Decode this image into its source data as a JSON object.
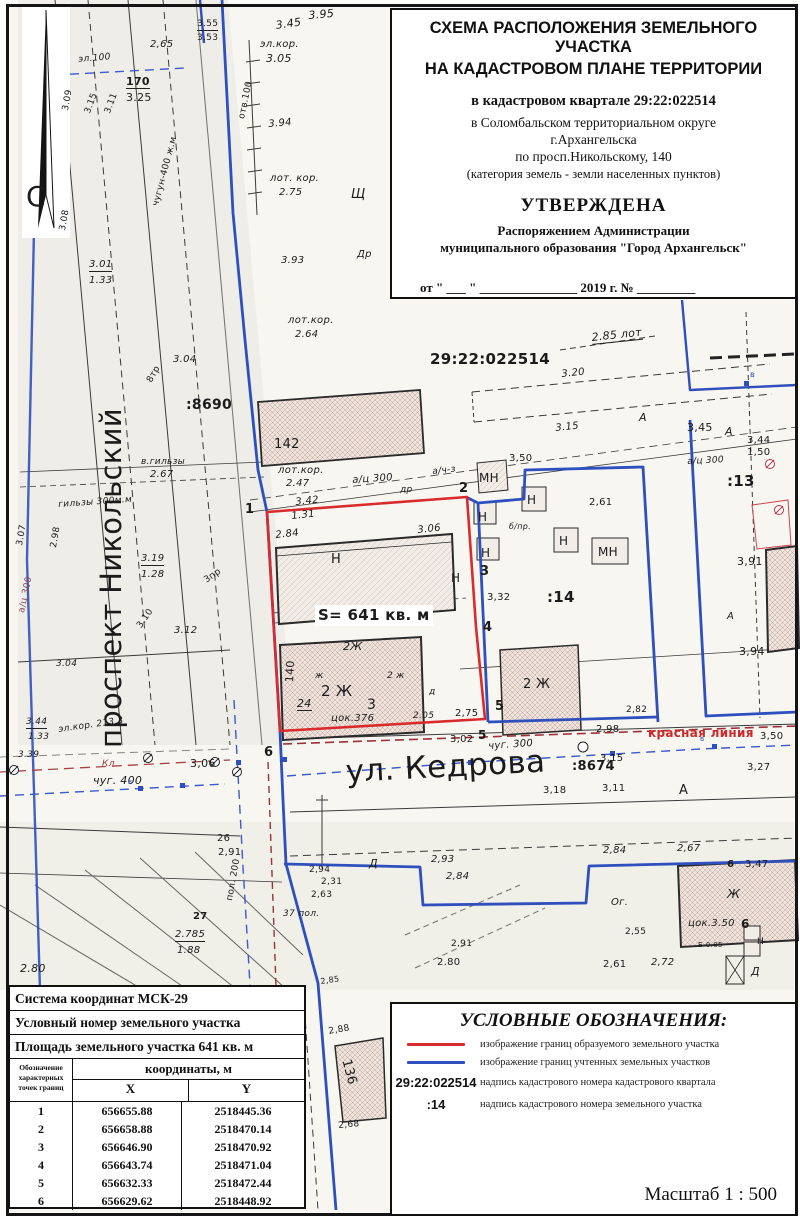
{
  "title_block": {
    "heading1": "СХЕМА РАСПОЛОЖЕНИЯ ЗЕМЕЛЬНОГО УЧАСТКА",
    "heading2": "НА КАДАСТРОВОМ ПЛАНЕ ТЕРРИТОРИИ",
    "quarter_line": "в кадастровом квартале 29:22:022514",
    "district_line1": "в Соломбальском территориальном округе",
    "district_line2": "г.Архангельска",
    "address_line": "по просп.Никольскому, 140",
    "category_line": "(категория земель - земли населенных пунктов)",
    "approved": "УТВЕРЖДЕНА",
    "approved_by1": "Распоряжением Администрации",
    "approved_by2": "муниципального образования \"Город Архангельск\"",
    "date_line": "от \" ___ \" _______________ 2019 г.  №  _________"
  },
  "legend": {
    "title": "УСЛОВНЫЕ ОБОЗНАЧЕНИЯ:",
    "items": [
      {
        "sample": "red",
        "symbol": "",
        "text": "изображение границ образуемого земельного участка"
      },
      {
        "sample": "blue",
        "symbol": "",
        "text": "изображение границ учтенных земельных участков"
      },
      {
        "sample": "label",
        "symbol": "29:22:022514",
        "text": "надпись кадастрового номера кадастрового квартала"
      },
      {
        "sample": "label",
        "symbol": ":14",
        "text": "надпись кадастрового номера земельного участка"
      }
    ],
    "scale": "Масштаб  1 : 500"
  },
  "table": {
    "row1": "Система координат МСК-29",
    "row2": "Условный номер земельного участка",
    "row3": "Площадь земельного участка 641 кв. м",
    "col_header_lines": [
      "Обозначение",
      "характерных",
      "точек границ"
    ],
    "coord_header": "координаты, м",
    "x_header": "X",
    "y_header": "Y",
    "rows": [
      [
        "1",
        "656655.88",
        "2518445.36"
      ],
      [
        "2",
        "656658.88",
        "2518470.14"
      ],
      [
        "3",
        "656646.90",
        "2518470.92"
      ],
      [
        "4",
        "656643.74",
        "2518471.04"
      ],
      [
        "5",
        "656632.33",
        "2518472.44"
      ],
      [
        "6",
        "656629.62",
        "2518448.92"
      ]
    ]
  },
  "colors": {
    "plot_boundary": "#d92b2b",
    "cadastral_boundary": "#2f4fbe",
    "red_line_text": "#cc2a2a"
  },
  "map": {
    "labels": [
      {
        "t": "С",
        "x": 26,
        "y": 183,
        "fs": 28
      },
      {
        "t": "проспект Никольский",
        "x": 97,
        "y": 748,
        "fs": 29,
        "rot": -90
      },
      {
        "t": "ул. Кедрова",
        "x": 345,
        "y": 757,
        "fs": 31,
        "rot": -3
      },
      {
        "t": "3.95",
        "x": 308,
        "y": 10,
        "fs": 11,
        "i": 1,
        "rot": -5
      },
      {
        "t": "3.45",
        "x": 275,
        "y": 20,
        "fs": 11,
        "i": 1,
        "rot": -8
      },
      {
        "t": "эл.кор.",
        "x": 260,
        "y": 40,
        "fs": 10,
        "i": 1
      },
      {
        "t": "3.05",
        "x": 266,
        "y": 53,
        "fs": 11,
        "i": 1
      },
      {
        "t": "2,65",
        "x": 150,
        "y": 40,
        "fs": 10,
        "i": 1
      },
      {
        "t": "170",
        "x": 126,
        "y": 76,
        "fs": 11,
        "b": 1,
        "u": 1
      },
      {
        "t": "3.25",
        "x": 126,
        "y": 92,
        "fs": 11
      },
      {
        "t": "3.55",
        "x": 197,
        "y": 20,
        "fs": 9,
        "u": 1
      },
      {
        "t": "3.53",
        "x": 197,
        "y": 34,
        "fs": 9
      },
      {
        "t": "эл.100",
        "x": 78,
        "y": 56,
        "fs": 9,
        "i": 1,
        "rot": -5
      },
      {
        "t": "отв.100",
        "x": 238,
        "y": 118,
        "fs": 9,
        "rot": -78
      },
      {
        "t": "3.94",
        "x": 268,
        "y": 120,
        "fs": 10,
        "i": 1,
        "rot": -5
      },
      {
        "t": "лот. кор.",
        "x": 270,
        "y": 174,
        "fs": 10,
        "i": 1
      },
      {
        "t": "2.75",
        "x": 279,
        "y": 188,
        "fs": 10,
        "i": 1
      },
      {
        "t": "Щ",
        "x": 351,
        "y": 188,
        "fs": 13,
        "i": 1
      },
      {
        "t": "3.93",
        "x": 281,
        "y": 256,
        "fs": 10,
        "i": 1
      },
      {
        "t": "Др",
        "x": 357,
        "y": 250,
        "fs": 10,
        "i": 1
      },
      {
        "t": "3.01",
        "x": 89,
        "y": 260,
        "fs": 10,
        "i": 1,
        "u": 1
      },
      {
        "t": "1.33",
        "x": 89,
        "y": 276,
        "fs": 10,
        "i": 1
      },
      {
        "t": "чугун-400 ж.м",
        "x": 152,
        "y": 205,
        "fs": 9,
        "rot": -75
      },
      {
        "t": "3.09",
        "x": 62,
        "y": 110,
        "fs": 9,
        "rot": -80
      },
      {
        "t": "3.15",
        "x": 84,
        "y": 112,
        "fs": 9,
        "rot": -70
      },
      {
        "t": "3.11",
        "x": 104,
        "y": 112,
        "fs": 9,
        "rot": -70
      },
      {
        "t": "3.08",
        "x": 59,
        "y": 230,
        "fs": 9,
        "rot": -80
      },
      {
        "t": "лот.кор.",
        "x": 288,
        "y": 316,
        "fs": 10,
        "i": 1
      },
      {
        "t": "2.64",
        "x": 295,
        "y": 330,
        "fs": 10,
        "i": 1
      },
      {
        "t": ":8690",
        "x": 186,
        "y": 398,
        "fs": 14,
        "b": 1
      },
      {
        "t": "142",
        "x": 274,
        "y": 438,
        "fs": 13
      },
      {
        "t": "в.гильзы",
        "x": 141,
        "y": 458,
        "fs": 9,
        "i": 1
      },
      {
        "t": "2.67",
        "x": 150,
        "y": 470,
        "fs": 10,
        "i": 1
      },
      {
        "t": "гильзы 300м.м",
        "x": 58,
        "y": 501,
        "fs": 9,
        "i": 1,
        "rot": -4
      },
      {
        "t": "3.04",
        "x": 173,
        "y": 355,
        "fs": 10,
        "i": 1
      },
      {
        "t": "8тр",
        "x": 146,
        "y": 380,
        "fs": 9,
        "rot": -60
      },
      {
        "t": "лот.кор.",
        "x": 278,
        "y": 466,
        "fs": 10,
        "i": 1
      },
      {
        "t": "2.47",
        "x": 286,
        "y": 479,
        "fs": 10,
        "i": 1
      },
      {
        "t": "3.19",
        "x": 141,
        "y": 554,
        "fs": 10,
        "i": 1,
        "u": 1
      },
      {
        "t": "1.28",
        "x": 141,
        "y": 570,
        "fs": 10,
        "i": 1
      },
      {
        "t": "3пр",
        "x": 203,
        "y": 578,
        "fs": 9,
        "rot": -35
      },
      {
        "t": "3.12",
        "x": 174,
        "y": 626,
        "fs": 10,
        "i": 1
      },
      {
        "t": "3.10",
        "x": 136,
        "y": 625,
        "fs": 9,
        "rot": -55
      },
      {
        "t": "3.04",
        "x": 56,
        "y": 660,
        "fs": 9,
        "i": 1
      },
      {
        "t": "3.44",
        "x": 26,
        "y": 718,
        "fs": 9,
        "i": 1,
        "u": 1
      },
      {
        "t": "1.33",
        "x": 28,
        "y": 733,
        "fs": 9,
        "i": 1
      },
      {
        "t": "эл.кор. 213.3",
        "x": 58,
        "y": 726,
        "fs": 9,
        "i": 1,
        "rot": -8
      },
      {
        "t": "3.39",
        "x": 18,
        "y": 751,
        "fs": 9,
        "i": 1
      },
      {
        "t": "а/ц 300",
        "x": 18,
        "y": 612,
        "fs": 9,
        "rot": -78,
        "c": "#8a4a52"
      },
      {
        "t": "3.07",
        "x": 16,
        "y": 545,
        "fs": 9,
        "rot": -80
      },
      {
        "t": "2.98",
        "x": 50,
        "y": 547,
        "fs": 9,
        "rot": -80
      },
      {
        "t": "Кл",
        "x": 102,
        "y": 760,
        "fs": 9,
        "c": "#a03c3c",
        "i": 1
      },
      {
        "t": "чуг. 400",
        "x": 93,
        "y": 775,
        "fs": 11,
        "i": 1
      },
      {
        "t": "3,06",
        "x": 190,
        "y": 758,
        "fs": 11
      },
      {
        "t": "6",
        "x": 264,
        "y": 746,
        "fs": 13,
        "b": 1
      },
      {
        "t": "в",
        "x": 128,
        "y": 779,
        "fs": 7,
        "c": "#2f4fbe"
      },
      {
        "t": "в",
        "x": 700,
        "y": 736,
        "fs": 7,
        "c": "#2f4fbe"
      },
      {
        "t": "в",
        "x": 750,
        "y": 371,
        "fs": 8,
        "c": "#2f4fbe"
      },
      {
        "t": "чуг. 300",
        "x": 488,
        "y": 742,
        "fs": 10,
        "i": 1,
        "rot": -4
      },
      {
        "t": ":8674",
        "x": 572,
        "y": 760,
        "fs": 13,
        "b": 1
      },
      {
        "t": "3,15",
        "x": 600,
        "y": 754,
        "fs": 10
      },
      {
        "t": "2,98",
        "x": 596,
        "y": 725,
        "fs": 10
      },
      {
        "t": "красная линия",
        "x": 648,
        "y": 727,
        "fs": 12,
        "b": 1,
        "c": "#cc2a2a"
      },
      {
        "t": "3,50",
        "x": 760,
        "y": 732,
        "fs": 10
      },
      {
        "t": "3,02",
        "x": 450,
        "y": 735,
        "fs": 10
      },
      {
        "t": "5",
        "x": 478,
        "y": 729,
        "fs": 12,
        "b": 1
      },
      {
        "t": "3,18",
        "x": 543,
        "y": 786,
        "fs": 10
      },
      {
        "t": "3,11",
        "x": 602,
        "y": 784,
        "fs": 10
      },
      {
        "t": "А",
        "x": 679,
        "y": 784,
        "fs": 13
      },
      {
        "t": "3,27",
        "x": 747,
        "y": 763,
        "fs": 10
      },
      {
        "t": "26",
        "x": 217,
        "y": 834,
        "fs": 10
      },
      {
        "t": "2,91",
        "x": 218,
        "y": 848,
        "fs": 10
      },
      {
        "t": "пол. 200",
        "x": 226,
        "y": 900,
        "fs": 9,
        "rot": -80
      },
      {
        "t": "27",
        "x": 193,
        "y": 912,
        "fs": 10,
        "b": 1
      },
      {
        "t": "2.785",
        "x": 175,
        "y": 930,
        "fs": 10,
        "i": 1,
        "u": 1
      },
      {
        "t": "1.88",
        "x": 177,
        "y": 946,
        "fs": 10,
        "i": 1
      },
      {
        "t": "37 пол.",
        "x": 283,
        "y": 910,
        "fs": 9,
        "i": 1
      },
      {
        "t": "2,94",
        "x": 309,
        "y": 866,
        "fs": 9
      },
      {
        "t": "2,31",
        "x": 321,
        "y": 878,
        "fs": 9
      },
      {
        "t": "2,63",
        "x": 311,
        "y": 891,
        "fs": 9
      },
      {
        "t": "2.80",
        "x": 20,
        "y": 963,
        "fs": 11,
        "i": 1
      },
      {
        "t": "Д",
        "x": 369,
        "y": 858,
        "fs": 11,
        "i": 1
      },
      {
        "t": "2,93",
        "x": 431,
        "y": 855,
        "fs": 10,
        "i": 1
      },
      {
        "t": "2,84",
        "x": 446,
        "y": 872,
        "fs": 10,
        "i": 1
      },
      {
        "t": "2,84",
        "x": 603,
        "y": 846,
        "fs": 10,
        "i": 1
      },
      {
        "t": "2,67",
        "x": 677,
        "y": 844,
        "fs": 10,
        "i": 1
      },
      {
        "t": "2,91",
        "x": 451,
        "y": 940,
        "fs": 9
      },
      {
        "t": "2.80",
        "x": 437,
        "y": 958,
        "fs": 10
      },
      {
        "t": "Б-0.05",
        "x": 698,
        "y": 942,
        "fs": 7
      },
      {
        "t": "Ог.",
        "x": 611,
        "y": 898,
        "fs": 10,
        "i": 1
      },
      {
        "t": "2,55",
        "x": 625,
        "y": 928,
        "fs": 9
      },
      {
        "t": "2,61",
        "x": 603,
        "y": 960,
        "fs": 10
      },
      {
        "t": "2,72",
        "x": 651,
        "y": 958,
        "fs": 10,
        "i": 1
      },
      {
        "t": "6",
        "x": 727,
        "y": 860,
        "fs": 10,
        "b": 1
      },
      {
        "t": "3,47",
        "x": 745,
        "y": 860,
        "fs": 10
      },
      {
        "t": "Ж",
        "x": 727,
        "y": 888,
        "fs": 12,
        "i": 1
      },
      {
        "t": "цок.3.50",
        "x": 688,
        "y": 919,
        "fs": 10,
        "i": 1
      },
      {
        "t": "6",
        "x": 741,
        "y": 918,
        "fs": 12,
        "b": 1
      },
      {
        "t": "Н",
        "x": 757,
        "y": 938,
        "fs": 9
      },
      {
        "t": "Д",
        "x": 751,
        "y": 966,
        "fs": 11,
        "i": 1
      },
      {
        "t": "136",
        "x": 352,
        "y": 1058,
        "fs": 13,
        "rot": 75
      },
      {
        "t": "2,88",
        "x": 328,
        "y": 1028,
        "fs": 9,
        "rot": -10
      },
      {
        "t": "2,68",
        "x": 338,
        "y": 1122,
        "fs": 9,
        "rot": -5
      },
      {
        "t": "2,85",
        "x": 320,
        "y": 978,
        "fs": 8,
        "rot": -8
      },
      {
        "t": "1",
        "x": 245,
        "y": 503,
        "fs": 13,
        "b": 1
      },
      {
        "t": "2",
        "x": 459,
        "y": 482,
        "fs": 13,
        "b": 1
      },
      {
        "t": "3",
        "x": 480,
        "y": 565,
        "fs": 13,
        "b": 1
      },
      {
        "t": "4",
        "x": 483,
        "y": 621,
        "fs": 13,
        "b": 1
      },
      {
        "t": "5",
        "x": 495,
        "y": 700,
        "fs": 13,
        "b": 1
      },
      {
        "t": "S= 641 кв. м",
        "x": 318,
        "y": 608,
        "fs": 15,
        "b": 1,
        "bg": 1
      },
      {
        "t": "3.42",
        "x": 295,
        "y": 498,
        "fs": 10,
        "i": 1,
        "rot": -6
      },
      {
        "t": "1.31",
        "x": 291,
        "y": 512,
        "fs": 10,
        "i": 1,
        "rot": -6
      },
      {
        "t": "2.84",
        "x": 275,
        "y": 531,
        "fs": 10,
        "i": 1,
        "rot": -6
      },
      {
        "t": "3.06",
        "x": 417,
        "y": 526,
        "fs": 10,
        "i": 1,
        "rot": -6
      },
      {
        "t": "Н",
        "x": 331,
        "y": 553,
        "fs": 13
      },
      {
        "t": "Н",
        "x": 451,
        "y": 572,
        "fs": 12
      },
      {
        "t": "а/ц 300",
        "x": 352,
        "y": 476,
        "fs": 10,
        "i": 1,
        "rot": -4
      },
      {
        "t": "др",
        "x": 400,
        "y": 486,
        "fs": 9,
        "i": 1
      },
      {
        "t": "а/ч-з",
        "x": 432,
        "y": 468,
        "fs": 9,
        "i": 1,
        "rot": -6
      },
      {
        "t": "2Ж",
        "x": 343,
        "y": 641,
        "fs": 11,
        "i": 1
      },
      {
        "t": "ж",
        "x": 315,
        "y": 672,
        "fs": 9,
        "i": 1
      },
      {
        "t": "2 Ж",
        "x": 321,
        "y": 684,
        "fs": 15
      },
      {
        "t": "3",
        "x": 367,
        "y": 698,
        "fs": 14
      },
      {
        "t": "цок.376",
        "x": 331,
        "y": 714,
        "fs": 10,
        "i": 1
      },
      {
        "t": "24",
        "x": 297,
        "y": 698,
        "fs": 11,
        "i": 1,
        "u": 1
      },
      {
        "t": "140",
        "x": 284,
        "y": 682,
        "fs": 11,
        "rot": -87
      },
      {
        "t": "д",
        "x": 429,
        "y": 688,
        "fs": 9,
        "i": 1
      },
      {
        "t": "2.05",
        "x": 413,
        "y": 712,
        "fs": 9,
        "i": 1
      },
      {
        "t": "2,75",
        "x": 455,
        "y": 709,
        "fs": 10
      },
      {
        "t": "2 ж",
        "x": 387,
        "y": 672,
        "fs": 9,
        "i": 1
      },
      {
        "t": "МН",
        "x": 479,
        "y": 472,
        "fs": 12
      },
      {
        "t": "3,50",
        "x": 509,
        "y": 454,
        "fs": 10
      },
      {
        "t": "Н",
        "x": 478,
        "y": 511,
        "fs": 12
      },
      {
        "t": "Н",
        "x": 481,
        "y": 547,
        "fs": 12
      },
      {
        "t": "Н",
        "x": 527,
        "y": 494,
        "fs": 12
      },
      {
        "t": "Н",
        "x": 559,
        "y": 535,
        "fs": 12
      },
      {
        "t": "МН",
        "x": 598,
        "y": 546,
        "fs": 12
      },
      {
        "t": "б/пр.",
        "x": 509,
        "y": 523,
        "fs": 8,
        "i": 1
      },
      {
        "t": "2,61",
        "x": 589,
        "y": 498,
        "fs": 10
      },
      {
        "t": ":14",
        "x": 547,
        "y": 590,
        "fs": 15,
        "b": 1
      },
      {
        "t": "3,32",
        "x": 487,
        "y": 593,
        "fs": 10
      },
      {
        "t": "2 Ж",
        "x": 523,
        "y": 678,
        "fs": 13
      },
      {
        "t": "2,82",
        "x": 626,
        "y": 706,
        "fs": 9
      },
      {
        "t": "29:22:022514",
        "x": 430,
        "y": 352,
        "fs": 15,
        "b": 1
      },
      {
        "t": "2.85 лот",
        "x": 591,
        "y": 332,
        "fs": 11,
        "i": 1,
        "rot": -6,
        "u": 1
      },
      {
        "t": "3.20",
        "x": 561,
        "y": 370,
        "fs": 10,
        "i": 1,
        "rot": -6
      },
      {
        "t": "3.15",
        "x": 555,
        "y": 424,
        "fs": 10,
        "i": 1,
        "rot": -6
      },
      {
        "t": "А",
        "x": 639,
        "y": 412,
        "fs": 11,
        "i": 1
      },
      {
        "t": "3,45",
        "x": 687,
        "y": 422,
        "fs": 11
      },
      {
        "t": "А",
        "x": 725,
        "y": 426,
        "fs": 11,
        "i": 1
      },
      {
        "t": "3,44",
        "x": 747,
        "y": 436,
        "fs": 10
      },
      {
        "t": "1,50",
        "x": 747,
        "y": 448,
        "fs": 10
      },
      {
        "t": "а/ц 300",
        "x": 687,
        "y": 458,
        "fs": 9,
        "i": 1,
        "rot": -3
      },
      {
        "t": ":13",
        "x": 727,
        "y": 474,
        "fs": 15,
        "b": 1
      },
      {
        "t": "3,91",
        "x": 737,
        "y": 556,
        "fs": 11
      },
      {
        "t": "А",
        "x": 727,
        "y": 612,
        "fs": 10,
        "i": 1
      },
      {
        "t": "3,94",
        "x": 739,
        "y": 646,
        "fs": 11
      }
    ]
  }
}
